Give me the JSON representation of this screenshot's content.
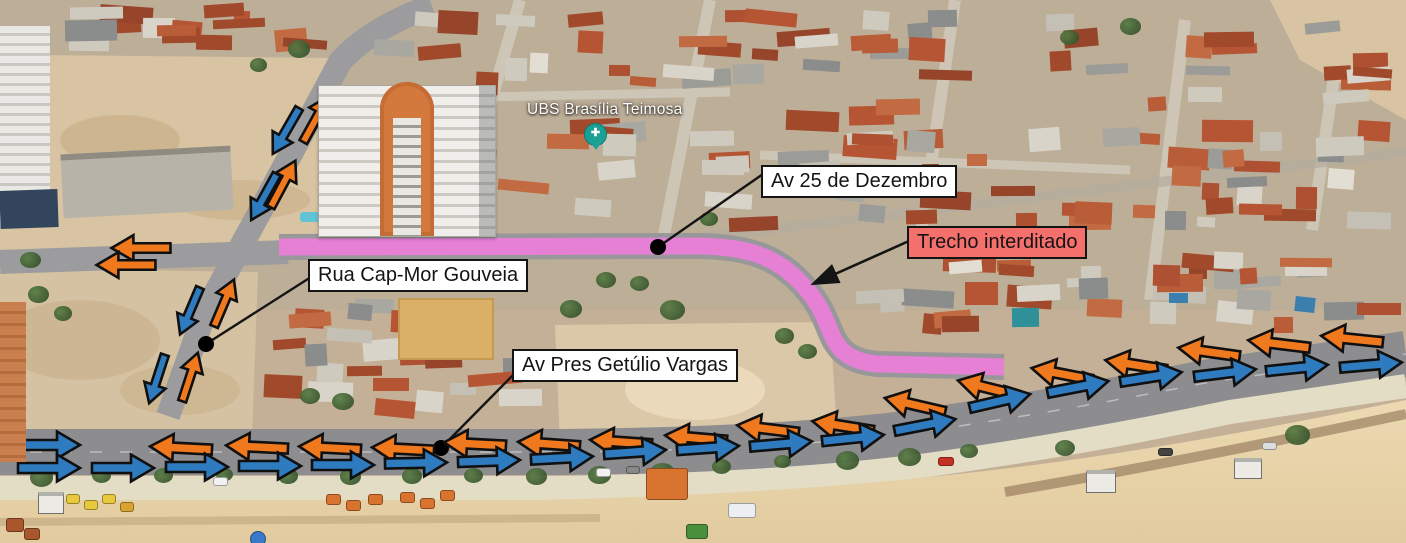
{
  "map": {
    "place_label": "UBS Brasília Teimosa",
    "place_pin": "health-facility-pin"
  },
  "annotations": {
    "colors": {
      "closed_route": "#e97ed8",
      "westbound_arrow": "#f0791e",
      "eastbound_arrow": "#2f7bbf",
      "alert_bg": "#f4706d",
      "leader": "#141414",
      "label_bg": "#ffffff"
    },
    "labels": [
      {
        "text": "Av 25 de Dezembro",
        "type": "white",
        "x": 761,
        "y": 165
      },
      {
        "text": "Trecho interditado",
        "type": "alert",
        "x": 907,
        "y": 226
      },
      {
        "text": "Rua Cap-Mor Gouveia",
        "type": "white",
        "x": 308,
        "y": 259
      },
      {
        "text": "Av Pres Getúlio Vargas",
        "type": "white",
        "x": 512,
        "y": 349
      }
    ],
    "route": {
      "name": "trecho interditado (Av 25 de Dezembro)",
      "path": "M279,247 L700,246 C752,247 776,259 796,278 C816,297 823,313 831,333 C839,353 853,362 878,364 L1004,367",
      "width": 17
    },
    "leaders": [
      {
        "x1": 763,
        "y1": 174,
        "x2": 658,
        "y2": 247
      },
      {
        "x1": 311,
        "y1": 277,
        "x2": 206,
        "y2": 344
      },
      {
        "x1": 517,
        "y1": 371,
        "x2": 441,
        "y2": 448
      }
    ],
    "pointer_arrow": {
      "x1": 909,
      "y1": 241,
      "x2": 815,
      "y2": 283
    },
    "dots": [
      {
        "x": 658,
        "y": 247
      },
      {
        "x": 206,
        "y": 344
      },
      {
        "x": 441,
        "y": 448
      }
    ],
    "arrows": [
      {
        "x": 316,
        "y": 119,
        "r": -61,
        "c": "orange",
        "s": 0.85
      },
      {
        "x": 286,
        "y": 131,
        "r": 120,
        "c": "blue",
        "s": 0.85
      },
      {
        "x": 283,
        "y": 184,
        "r": -62,
        "c": "orange",
        "s": 0.85
      },
      {
        "x": 264,
        "y": 197,
        "r": 119,
        "c": "blue",
        "s": 0.85
      },
      {
        "x": 224,
        "y": 303,
        "r": -67,
        "c": "orange",
        "s": 0.82
      },
      {
        "x": 190,
        "y": 311,
        "r": 113,
        "c": "blue",
        "s": 0.82
      },
      {
        "x": 190,
        "y": 377,
        "r": -72,
        "c": "orange",
        "s": 0.82
      },
      {
        "x": 157,
        "y": 379,
        "r": 108,
        "c": "blue",
        "s": 0.82
      },
      {
        "x": 141,
        "y": 248,
        "r": 180,
        "c": "orange",
        "s": 0.95
      },
      {
        "x": 126,
        "y": 265,
        "r": 180,
        "c": "orange",
        "s": 0.95
      },
      {
        "x": 181,
        "y": 448,
        "r": 183,
        "c": "orange"
      },
      {
        "x": 257,
        "y": 447,
        "r": 183,
        "c": "orange"
      },
      {
        "x": 330,
        "y": 448,
        "r": 183,
        "c": "orange"
      },
      {
        "x": 403,
        "y": 449,
        "r": 183,
        "c": "orange"
      },
      {
        "x": 475,
        "y": 444,
        "r": 183,
        "c": "orange"
      },
      {
        "x": 549,
        "y": 444,
        "r": 184,
        "c": "orange"
      },
      {
        "x": 621,
        "y": 442,
        "r": 184,
        "c": "orange"
      },
      {
        "x": 696,
        "y": 438,
        "r": 185,
        "c": "orange"
      },
      {
        "x": 768,
        "y": 429,
        "r": 187,
        "c": "orange"
      },
      {
        "x": 843,
        "y": 426,
        "r": 189,
        "c": "orange"
      },
      {
        "x": 915,
        "y": 405,
        "r": 193,
        "c": "orange"
      },
      {
        "x": 988,
        "y": 388,
        "r": 194,
        "c": "orange"
      },
      {
        "x": 1062,
        "y": 374,
        "r": 191,
        "c": "orange"
      },
      {
        "x": 1136,
        "y": 365,
        "r": 189,
        "c": "orange"
      },
      {
        "x": 1209,
        "y": 352,
        "r": 188,
        "c": "orange"
      },
      {
        "x": 1279,
        "y": 344,
        "r": 187,
        "c": "orange"
      },
      {
        "x": 1352,
        "y": 339,
        "r": 186,
        "c": "orange"
      },
      {
        "x": 49,
        "y": 445,
        "r": 0,
        "c": "blue"
      },
      {
        "x": 49,
        "y": 468,
        "r": 0,
        "c": "blue"
      },
      {
        "x": 123,
        "y": 468,
        "r": 0,
        "c": "blue"
      },
      {
        "x": 197,
        "y": 467,
        "r": 0,
        "c": "blue"
      },
      {
        "x": 270,
        "y": 466,
        "r": 0,
        "c": "blue"
      },
      {
        "x": 343,
        "y": 465,
        "r": 0,
        "c": "blue"
      },
      {
        "x": 416,
        "y": 463,
        "r": -1,
        "c": "blue"
      },
      {
        "x": 489,
        "y": 461,
        "r": -2,
        "c": "blue"
      },
      {
        "x": 562,
        "y": 458,
        "r": -3,
        "c": "blue"
      },
      {
        "x": 635,
        "y": 452,
        "r": -4,
        "c": "blue"
      },
      {
        "x": 708,
        "y": 448,
        "r": -4,
        "c": "blue"
      },
      {
        "x": 781,
        "y": 444,
        "r": -5,
        "c": "blue"
      },
      {
        "x": 853,
        "y": 438,
        "r": -6,
        "c": "blue"
      },
      {
        "x": 925,
        "y": 425,
        "r": -11,
        "c": "blue"
      },
      {
        "x": 1000,
        "y": 401,
        "r": -13,
        "c": "blue"
      },
      {
        "x": 1078,
        "y": 387,
        "r": -11,
        "c": "blue"
      },
      {
        "x": 1151,
        "y": 377,
        "r": -9,
        "c": "blue"
      },
      {
        "x": 1225,
        "y": 373,
        "r": -7,
        "c": "blue"
      },
      {
        "x": 1297,
        "y": 368,
        "r": -6,
        "c": "blue"
      },
      {
        "x": 1371,
        "y": 365,
        "r": -5,
        "c": "blue"
      }
    ]
  }
}
